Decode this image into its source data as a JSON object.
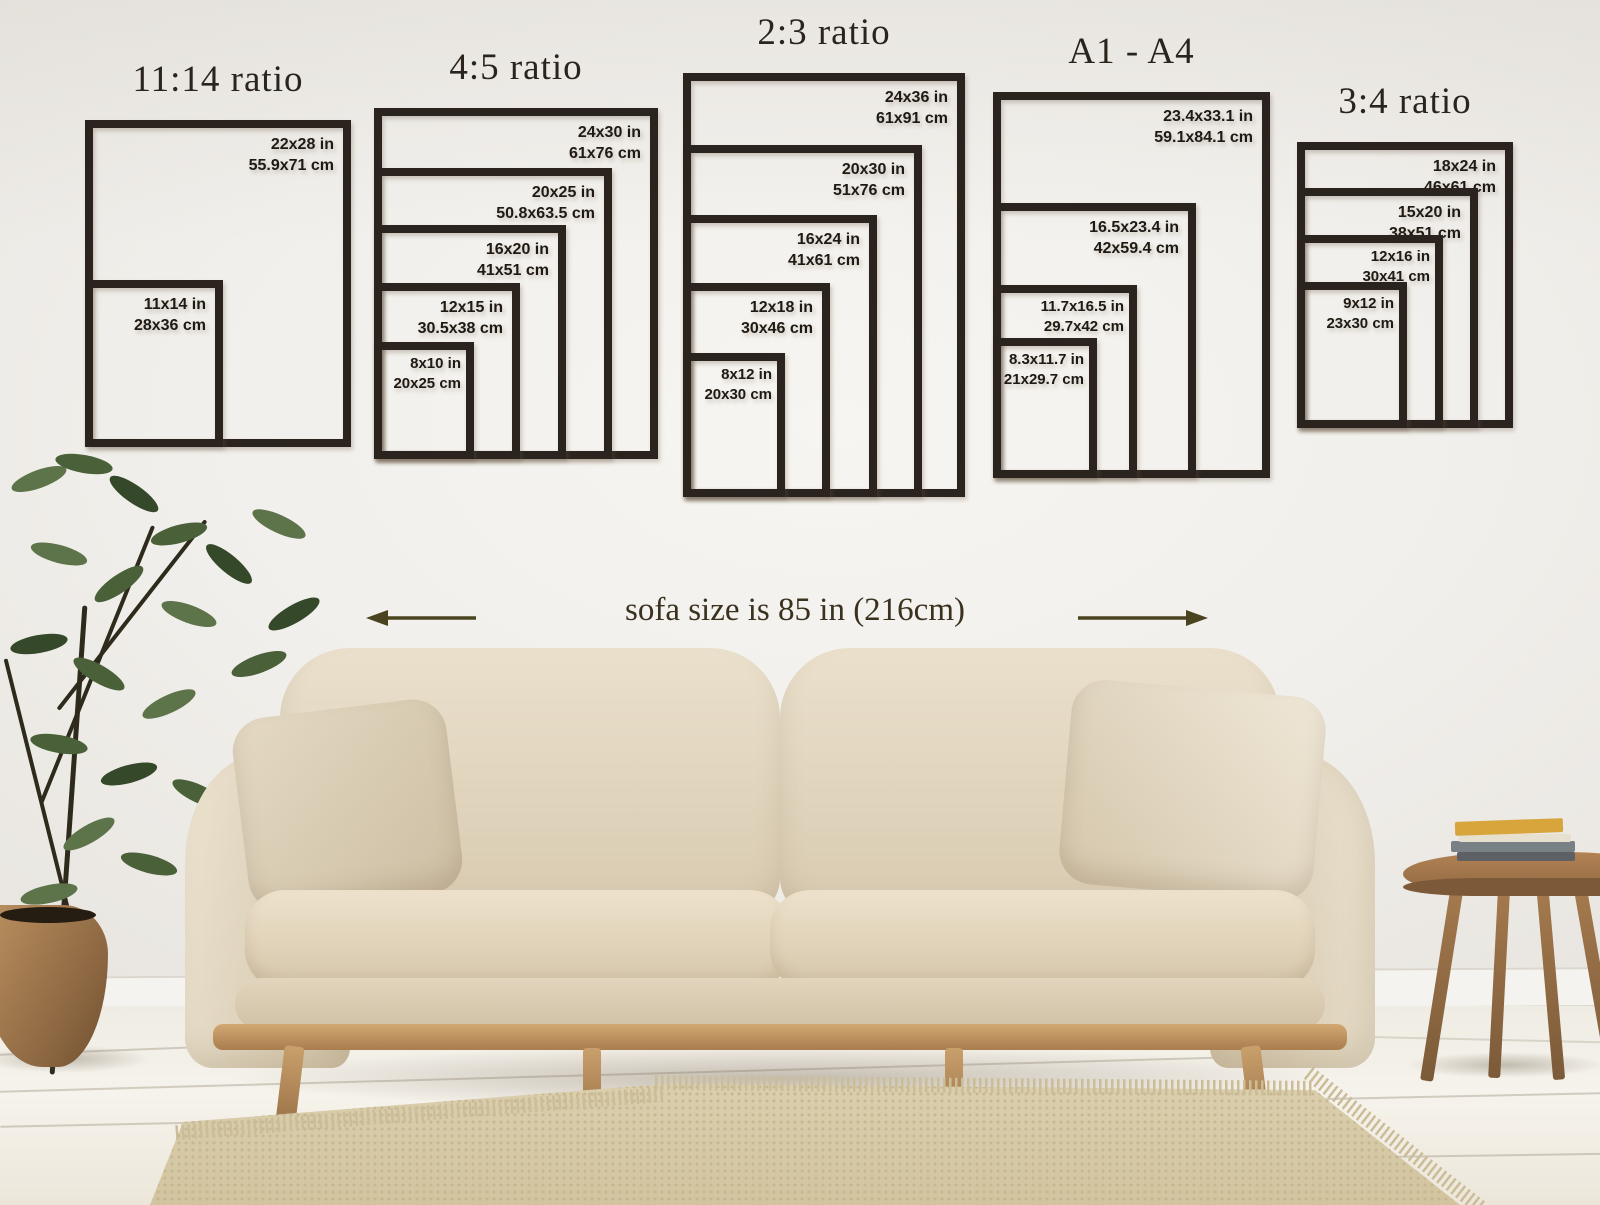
{
  "poster_guide": {
    "groups": [
      {
        "title": "11:14 ratio",
        "frames": [
          {
            "inches": "22x28 in",
            "cm": "55.9x71 cm"
          },
          {
            "inches": "11x14 in",
            "cm": "28x36 cm"
          }
        ]
      },
      {
        "title": "4:5 ratio",
        "frames": [
          {
            "inches": "24x30 in",
            "cm": "61x76 cm"
          },
          {
            "inches": "20x25 in",
            "cm": "50.8x63.5 cm"
          },
          {
            "inches": "16x20 in",
            "cm": "41x51 cm"
          },
          {
            "inches": "12x15 in",
            "cm": "30.5x38 cm"
          },
          {
            "inches": "8x10 in",
            "cm": "20x25 cm"
          }
        ]
      },
      {
        "title": "2:3 ratio",
        "frames": [
          {
            "inches": "24x36 in",
            "cm": "61x91 cm"
          },
          {
            "inches": "20x30 in",
            "cm": "51x76 cm"
          },
          {
            "inches": "16x24 in",
            "cm": "41x61 cm"
          },
          {
            "inches": "12x18 in",
            "cm": "30x46 cm"
          },
          {
            "inches": "8x12 in",
            "cm": "20x30 cm"
          }
        ]
      },
      {
        "title": "A1 - A4",
        "frames": [
          {
            "inches": "23.4x33.1 in",
            "cm": "59.1x84.1 cm"
          },
          {
            "inches": "16.5x23.4 in",
            "cm": "42x59.4 cm"
          },
          {
            "inches": "11.7x16.5 in",
            "cm": "29.7x42 cm"
          },
          {
            "inches": "8.3x11.7 in",
            "cm": "21x29.7 cm"
          }
        ]
      },
      {
        "title": "3:4 ratio",
        "frames": [
          {
            "inches": "18x24 in",
            "cm": "46x61 cm"
          },
          {
            "inches": "15x20 in",
            "cm": "38x51 cm"
          },
          {
            "inches": "12x16 in",
            "cm": "30x41 cm"
          },
          {
            "inches": "9x12 in",
            "cm": "23x30 cm"
          }
        ]
      }
    ],
    "sofa_note": "sofa size is 85 in (216cm)"
  },
  "colors": {
    "frame_line": "#2b241e",
    "label_text": "#1f1913",
    "title_text": "#2a241d",
    "note_text": "#3a321f",
    "arrow": "#4a431f",
    "wall": "#f1efeb",
    "sofa_fabric": "#ddd2bc",
    "wood": "#b98f5e",
    "floor": "#f2eee6",
    "rug": "#d7caa8",
    "plant_green": "#4a6039"
  }
}
